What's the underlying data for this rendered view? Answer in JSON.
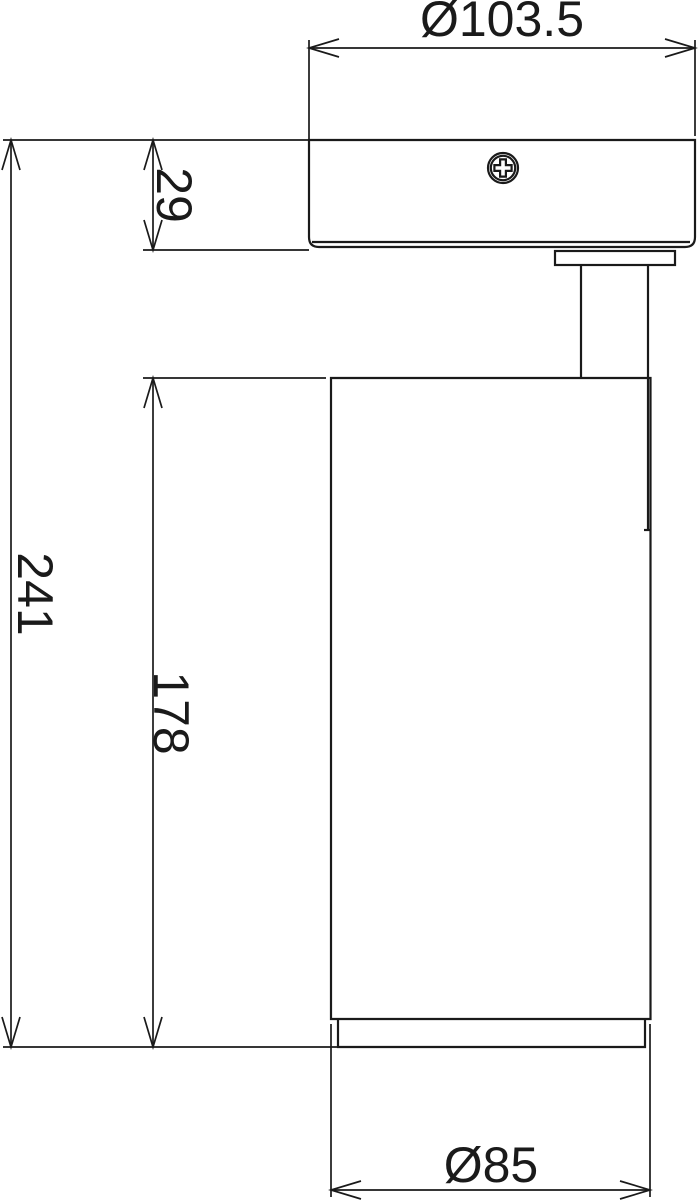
{
  "colors": {
    "line": "#1a1a1a",
    "background": "#ffffff"
  },
  "drawing": {
    "dimensions": {
      "canopy_diameter": {
        "label": "Ø103.5"
      },
      "canopy_height": {
        "label": "29"
      },
      "overall_height": {
        "label": "241"
      },
      "body_height": {
        "label": "178"
      },
      "body_diameter": {
        "label": "Ø85"
      }
    }
  }
}
